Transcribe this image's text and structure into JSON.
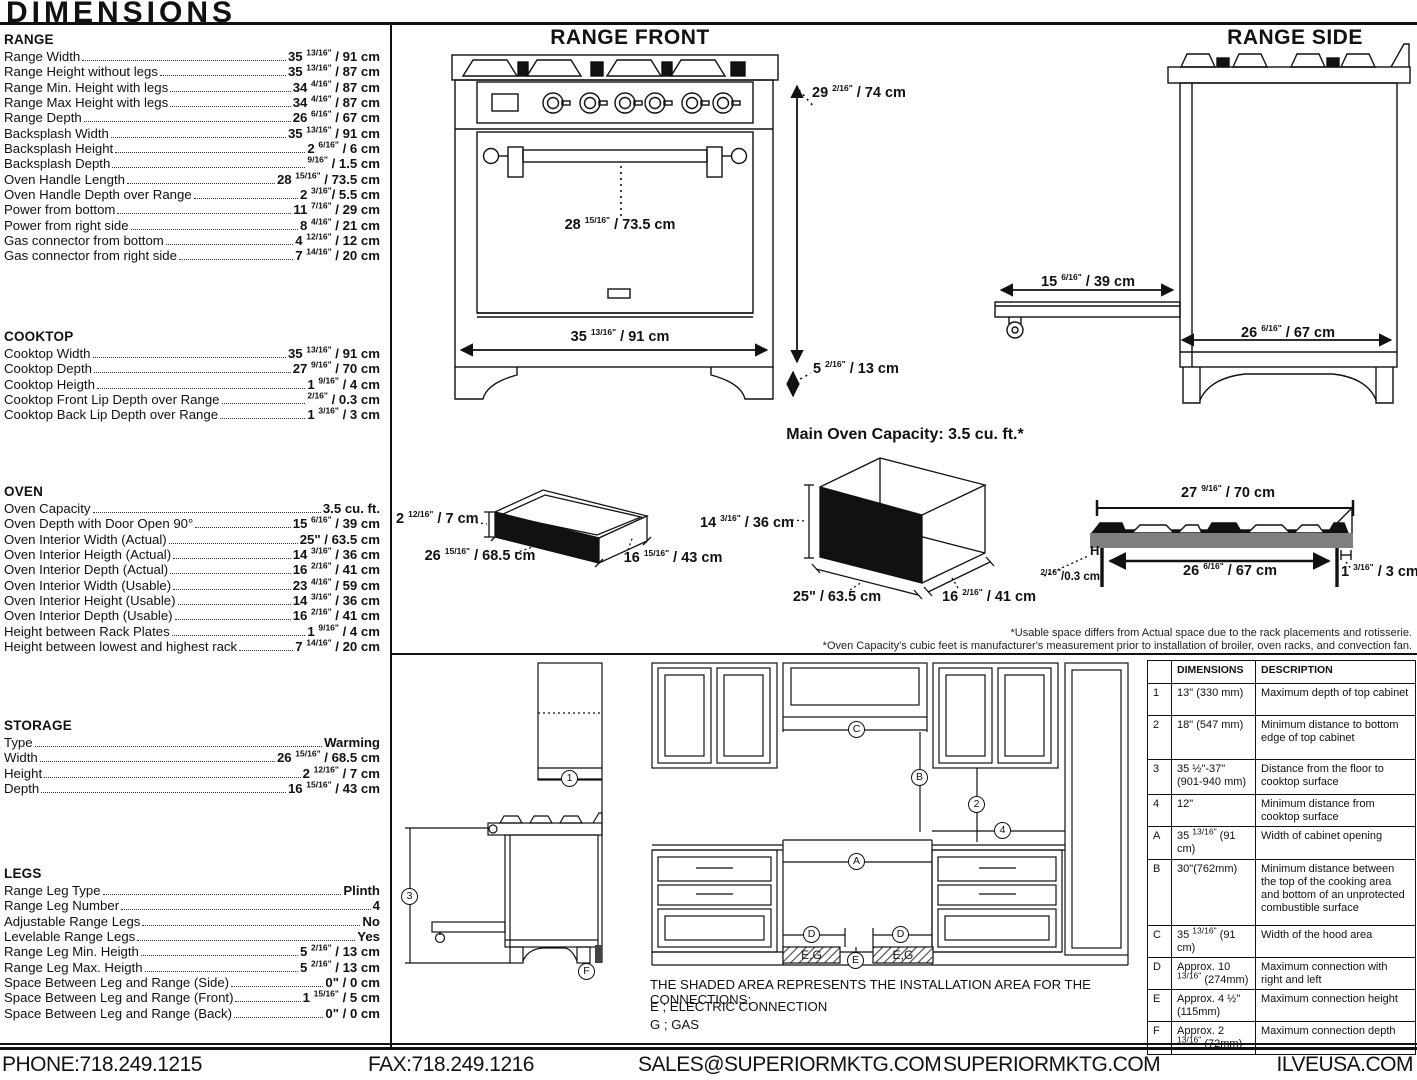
{
  "title": "DIMENSIONS",
  "specs": {
    "range": {
      "heading": "RANGE",
      "rows": [
        {
          "label": "Range Width",
          "value": "35 13/16\" / 91 cm"
        },
        {
          "label": "Range Height without legs",
          "value": "35 13/16\" / 87 cm"
        },
        {
          "label": "Range Min. Height with legs",
          "value": "34 4/16\" / 87 cm"
        },
        {
          "label": "Range Max Height with legs",
          "value": "34 4/16\" / 87 cm"
        },
        {
          "label": "Range Depth",
          "value": "26 6/16\" / 67 cm"
        },
        {
          "label": "Backsplash Width",
          "value": "35 13/16\" / 91 cm"
        },
        {
          "label": "Backsplash Height",
          "value": "2 6/16\" / 6 cm"
        },
        {
          "label": "Backsplash Depth",
          "value": "9/16\" / 1.5 cm"
        },
        {
          "label": "Oven Handle Length",
          "value": "28 15/16\" / 73.5 cm"
        },
        {
          "label": "Oven Handle Depth over Range",
          "value": "2 3/16\"/ 5.5 cm"
        },
        {
          "label": "Power from bottom",
          "value": "11 7/16\" / 29 cm"
        },
        {
          "label": "Power from right side",
          "value": "8 4/16\" / 21 cm"
        },
        {
          "label": "Gas connector from bottom",
          "value": "4 12/16\" / 12 cm"
        },
        {
          "label": "Gas connector from right side",
          "value": "7 14/16\" / 20 cm"
        }
      ]
    },
    "cooktop": {
      "heading": "COOKTOP",
      "rows": [
        {
          "label": "Cooktop Width",
          "value": "35 13/16\" / 91 cm"
        },
        {
          "label": "Cooktop Depth",
          "value": "27 9/16\" / 70 cm"
        },
        {
          "label": "Cooktop Heigth",
          "value": "1 9/16\" / 4 cm"
        },
        {
          "label": "Cooktop Front Lip Depth over Range",
          "value": "2/16\" / 0.3 cm"
        },
        {
          "label": "Cooktop Back Lip Depth over Range",
          "value": "1 3/16\" / 3 cm"
        }
      ]
    },
    "oven": {
      "heading": "OVEN",
      "rows": [
        {
          "label": "Oven Capacity",
          "value": "3.5 cu. ft."
        },
        {
          "label": "Oven Depth with Door Open 90°",
          "value": "15 6/16\" / 39 cm"
        },
        {
          "label": "Oven Interior Width (Actual)",
          "value": "25\" / 63.5 cm"
        },
        {
          "label": "Oven Interior Heigth (Actual)",
          "value": "14 3/16\" / 36 cm"
        },
        {
          "label": "Oven Interior Depth (Actual)",
          "value": "16 2/16\" / 41 cm"
        },
        {
          "label": "Oven Interior Width (Usable)",
          "value": "23 4/16\" / 59 cm"
        },
        {
          "label": "Oven Interior Height (Usable)",
          "value": "14 3/16\" / 36 cm"
        },
        {
          "label": "Oven Interior Depth (Usable)",
          "value": "16 2/16\" / 41 cm"
        },
        {
          "label": "Height between Rack Plates",
          "value": "1 9/16\" / 4 cm"
        },
        {
          "label": "Height between lowest and highest rack",
          "value": "7 14/16\" / 20 cm"
        }
      ]
    },
    "storage": {
      "heading": "STORAGE",
      "rows": [
        {
          "label": "Type",
          "value": "Warming"
        },
        {
          "label": "Width",
          "value": "26 15/16\" / 68.5 cm"
        },
        {
          "label": "Height",
          "value": "2 12/16\" / 7 cm"
        },
        {
          "label": "Depth",
          "value": "16 15/16\" / 43 cm"
        }
      ]
    },
    "legs": {
      "heading": "LEGS",
      "rows": [
        {
          "label": "Range Leg Type",
          "value": "Plinth"
        },
        {
          "label": "Range Leg Number",
          "value": "4"
        },
        {
          "label": "Adjustable Range Legs",
          "value": "No"
        },
        {
          "label": "Levelable Range Legs",
          "value": "Yes"
        },
        {
          "label": "Range Leg Min. Heigth",
          "value": "5 2/16\" / 13 cm"
        },
        {
          "label": "Range Leg Max. Heigth",
          "value": "5 2/16\" / 13 cm"
        },
        {
          "label": "Space Between Leg and Range (Side)",
          "value": "0\" / 0 cm"
        },
        {
          "label": "Space Between Leg and Range (Front)",
          "value": "1 15/16\" / 5 cm"
        },
        {
          "label": "Space Between Leg and Range (Back)",
          "value": "0\" / 0 cm"
        }
      ]
    }
  },
  "front": {
    "title": "RANGE FRONT",
    "height": "29 2/16\" / 74 cm",
    "handle": "28 15/16\" / 73.5 cm",
    "width": "35 13/16\" / 91 cm",
    "leg": "5 2/16\" / 13 cm"
  },
  "side": {
    "title": "RANGE SIDE",
    "door": "15 6/16\" / 39 cm",
    "depth": "26 6/16\" / 67 cm"
  },
  "drawer": {
    "height": "2 12/16\" / 7 cm",
    "width": "26 15/16\" / 68.5 cm",
    "depth": "16 15/16\" / 43 cm"
  },
  "oven_box": {
    "title": "Main Oven Capacity: 3.5 cu. ft.*",
    "height": "14 3/16\" / 36 cm",
    "width": "25\" / 63.5 cm",
    "depth": "16 2/16\" / 41 cm"
  },
  "cooktop_profile": {
    "top": "27 9/16\" / 70 cm",
    "inner": "26 6/16\" / 67 cm",
    "back_lip": "1 3/16\" / 3 cm",
    "front_lip": "2/16\"/0.3 cm",
    "h_label": "H"
  },
  "footnotes": {
    "line1": "*Usable space differs from Actual space due to the rack placements and rotisserie.",
    "line2": "*Oven Capacity's cubic feet is manufacturer's measurement prior to installation of broiler, oven racks, and convection fan."
  },
  "install": {
    "callouts": {
      "n1": "1",
      "n2": "2",
      "n3": "3",
      "n4": "4",
      "a": "A",
      "b": "B",
      "c": "C",
      "d": "D",
      "e": "E",
      "f": "F"
    },
    "hatch_label": "E,G",
    "note": "THE SHADED AREA REPRESENTS THE INSTALLATION AREA FOR THE CONNECTIONS;",
    "electric": "E ; ELECTRIC CONNECTION",
    "gas": "G ; GAS"
  },
  "table": {
    "col_dim": "DIMENSIONS",
    "col_desc": "DESCRIPTION",
    "rows": [
      {
        "id": "1",
        "dim": "13\" (330 mm)",
        "desc": "Maximum depth of top cabinet"
      },
      {
        "id": "2",
        "dim": "18\" (547 mm)",
        "desc": "Minimum distance to bottom edge of top cabinet"
      },
      {
        "id": "3",
        "dim": "35 ½\"-37\" (901-940 mm)",
        "desc": "Distance from the floor to cooktop surface"
      },
      {
        "id": "4",
        "dim": "12\"",
        "desc": "Minimum distance from cooktop surface"
      },
      {
        "id": "A",
        "dim": "35 13/16\" (91 cm)",
        "desc": "Width of cabinet opening"
      },
      {
        "id": "B",
        "dim": "30\"(762mm)",
        "desc": "Minimum distance between the top of the cooking area and bottom of an unprotected combustible surface"
      },
      {
        "id": "C",
        "dim": "35 13/16\" (91 cm)",
        "desc": "Width of the hood area"
      },
      {
        "id": "D",
        "dim": "Approx. 10 13/16\" (274mm)",
        "desc": "Maximum connection with right and left"
      },
      {
        "id": "E",
        "dim": "Approx. 4 ½\" (115mm)",
        "desc": "Maximum connection height"
      },
      {
        "id": "F",
        "dim": "Approx. 2 13/16\" (72mm)",
        "desc": "Maximum connection depth"
      }
    ]
  },
  "footer": {
    "phone": "PHONE:718.249.1215",
    "fax": "FAX:718.249.1216",
    "email": "SALES@SUPERIORMKTG.COM",
    "site": "SUPERIORMKTG.COM",
    "ilve": "ILVEUSA.COM"
  }
}
